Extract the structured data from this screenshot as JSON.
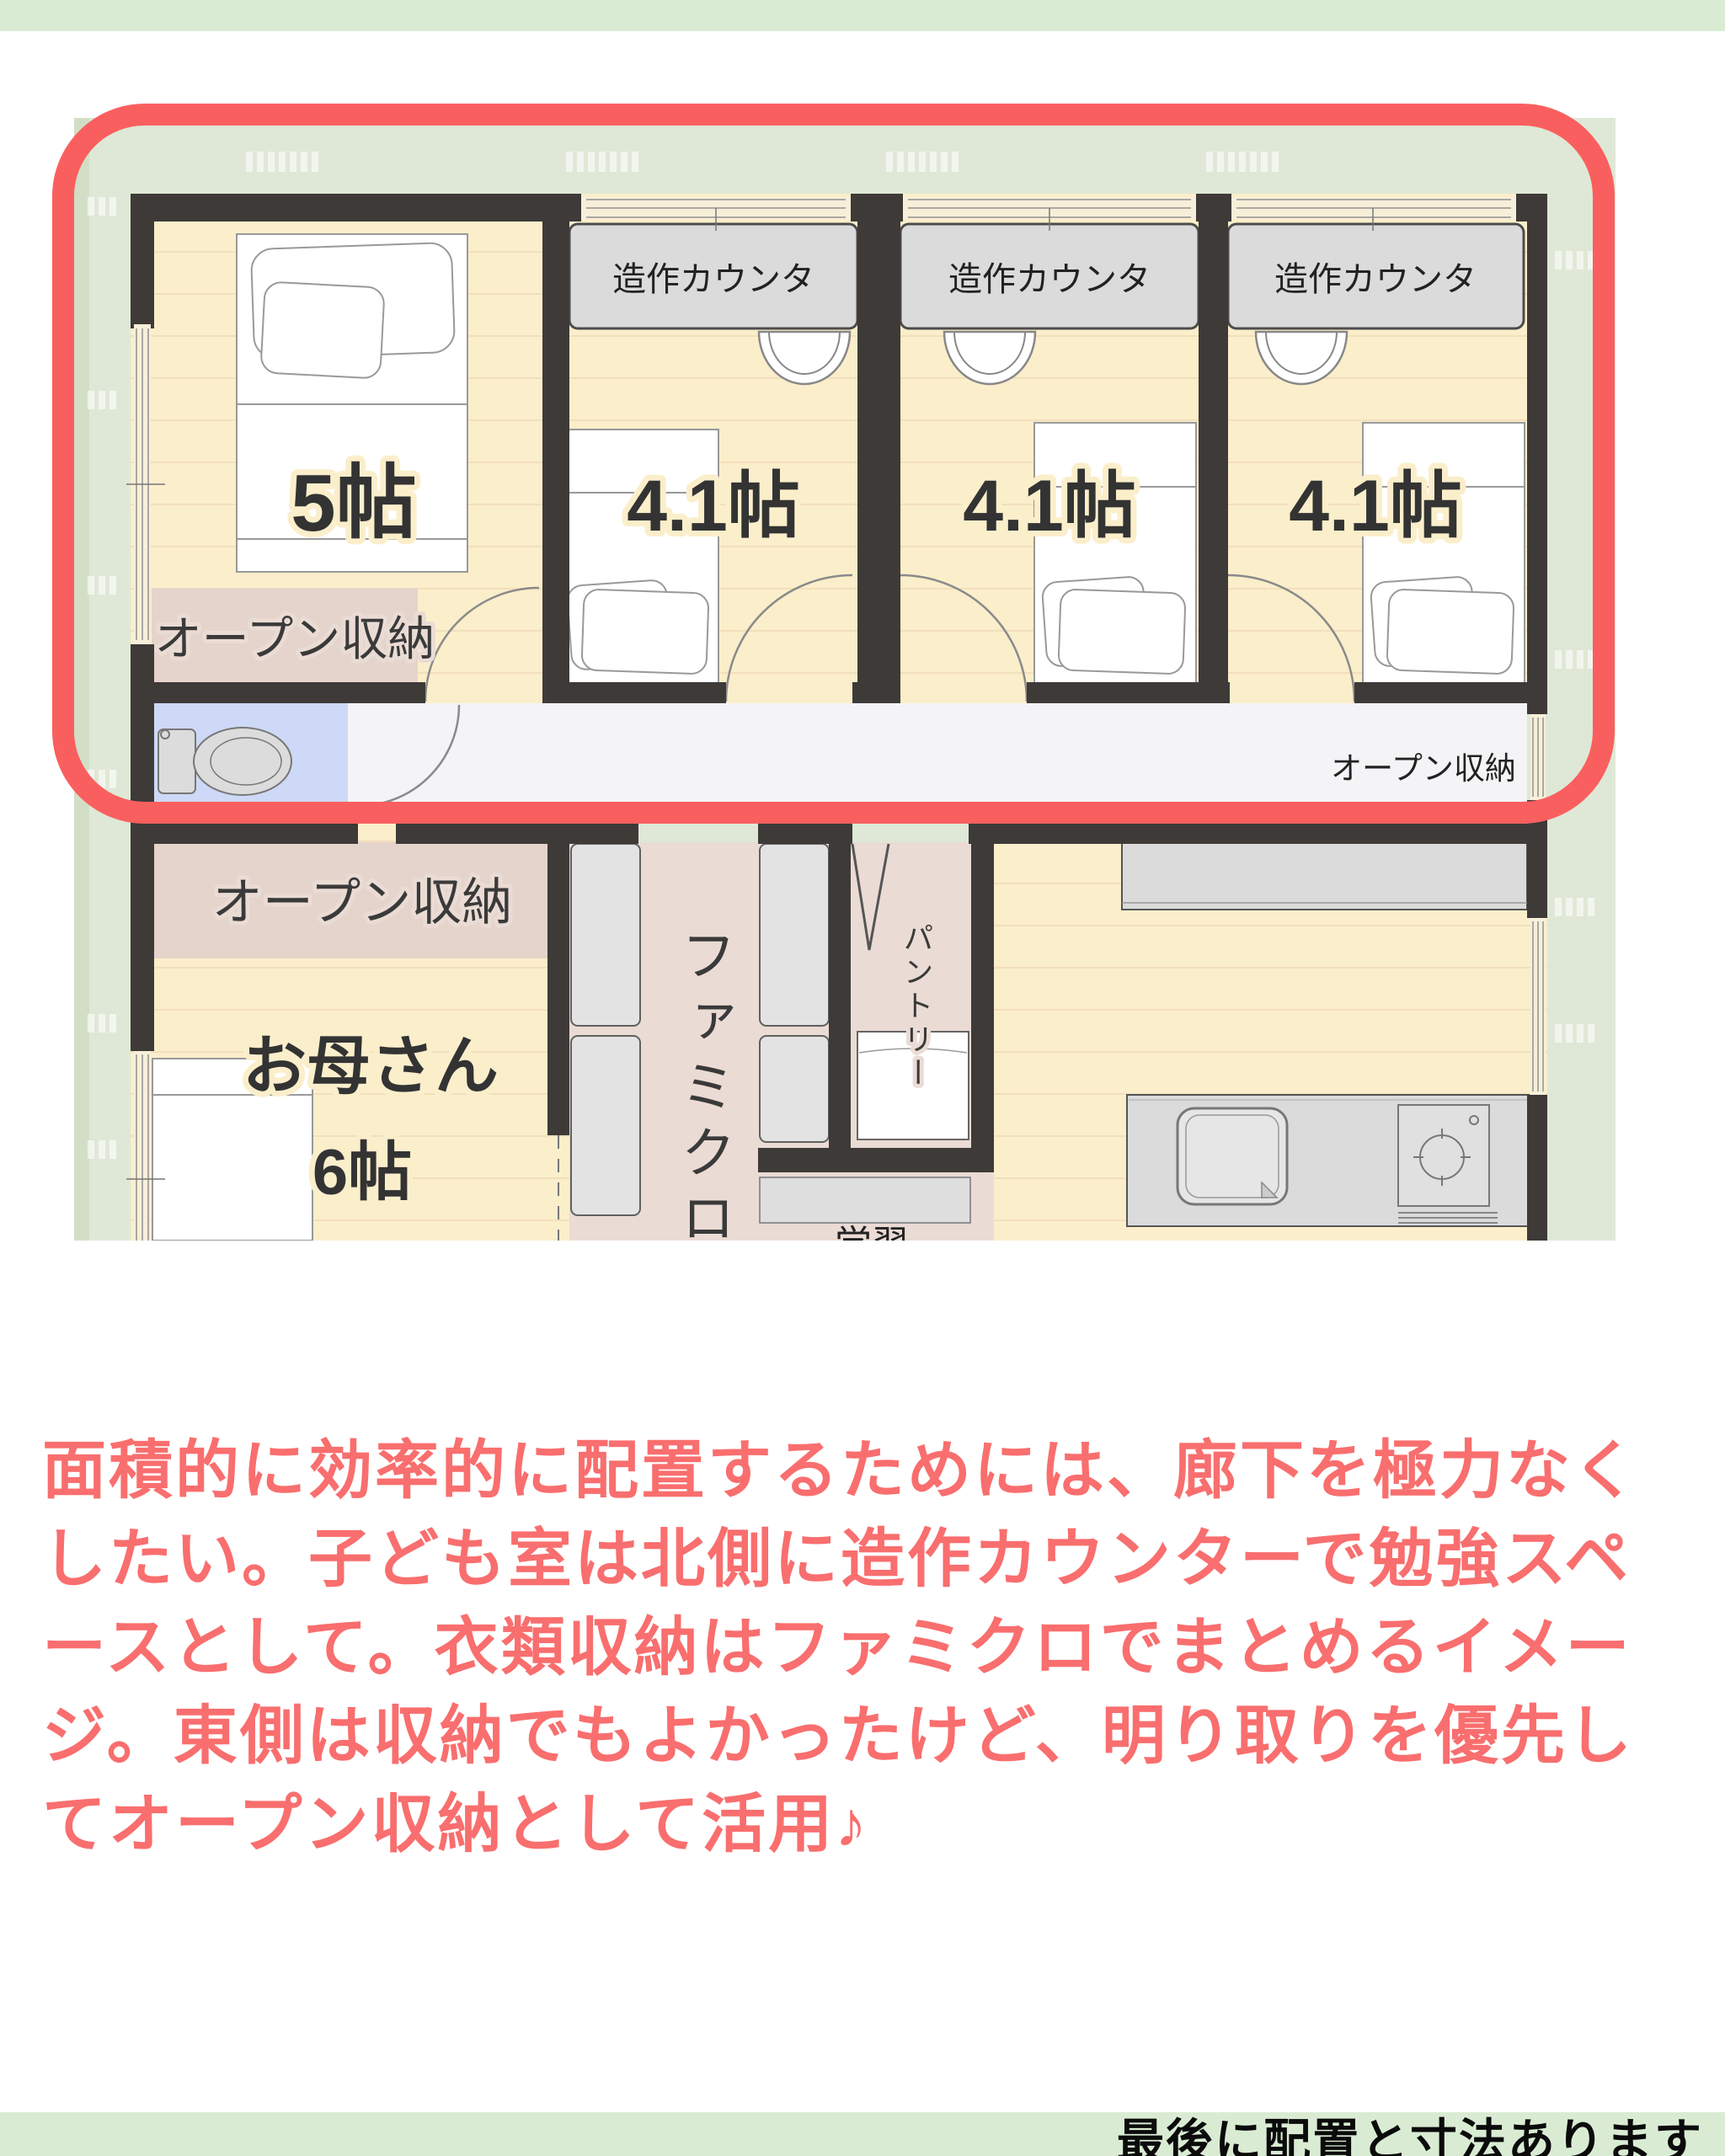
{
  "colors": {
    "bar_green": "#d9ecd3",
    "site_green": "#dfe8d6",
    "site_green_edge": "#d2dfc6",
    "wall": "#3d3a38",
    "floor": "#fbeecb",
    "plank_line": "#f2dfbc",
    "corridor": "#f4f4f6",
    "toilet_floor": "#cdd9f6",
    "storage_pink": "#e4d4cb",
    "famiclo_floor": "#eadbd4",
    "counter_gray": "#dbdbdb",
    "closet_gray": "#e3e3e3",
    "window_fill": "#f7efd9",
    "highlight_red": "#fa5f5f",
    "caption_red": "#f96e6e",
    "bottom_text": "#0b0b0b"
  },
  "plan": {
    "rooms": {
      "bedroom5_label": "5帖",
      "kids_label": "4.1帖",
      "mother_name": "お母さん",
      "mother_size": "6帖"
    },
    "labels": {
      "counter": "造作カウンタ",
      "open_storage": "オープン収納",
      "famiclo": "ファミクロ",
      "pantry": "パントリー",
      "study": "学習"
    }
  },
  "caption": {
    "lines": [
      "面積的に効率的に配置するためには、廊下を極力なく",
      "したい。子ども室は北側に造作カウンターで勉強スペ",
      "ースとして。衣類収納はファミクロでまとめるイメー",
      "ジ。東側は収納でもよかったけど、明り取りを優先し",
      "てオープン収納として活用♪"
    ]
  },
  "bottom_bar": {
    "text": "最後に配置と寸法あります"
  }
}
